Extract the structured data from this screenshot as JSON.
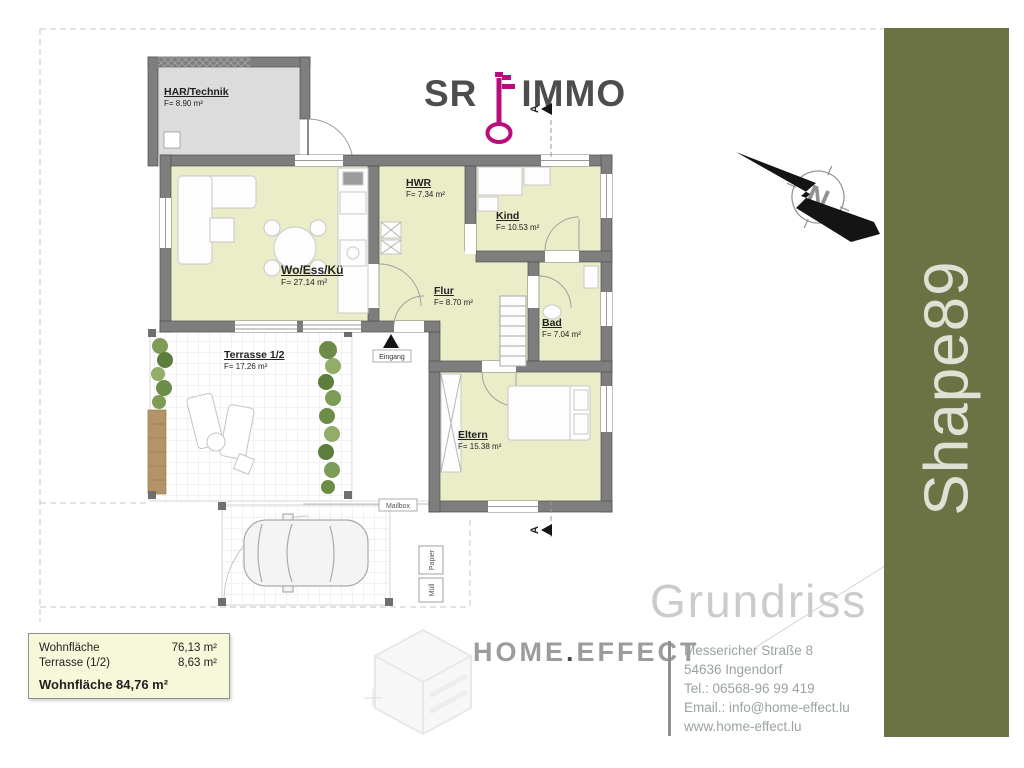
{
  "page": {
    "background": "#ffffff"
  },
  "logo": {
    "sr": "SR",
    "immo": "IMMO",
    "key_color": "#b90d7e",
    "text_color": "#4d4d4d"
  },
  "section_marker": {
    "letter": "A"
  },
  "compass": {
    "north_letter": "N"
  },
  "rooms": [
    {
      "id": "har",
      "name": "HAR/Technik",
      "area": "F= 8.90 m²"
    },
    {
      "id": "wo",
      "name": "Wo/Ess/Kü",
      "area": "F= 27.14 m²"
    },
    {
      "id": "hwr",
      "name": "HWR",
      "area": "F= 7.34 m²"
    },
    {
      "id": "kind",
      "name": "Kind",
      "area": "F= 10.53 m²"
    },
    {
      "id": "flur",
      "name": "Flur",
      "area": "F= 8.70 m²"
    },
    {
      "id": "bad",
      "name": "Bad",
      "area": "F= 7.04 m²"
    },
    {
      "id": "terrasse",
      "name": "Terrasse 1/2",
      "area": "F= 17.26 m²"
    },
    {
      "id": "eltern",
      "name": "Eltern",
      "area": "F= 15.38 m²"
    }
  ],
  "plan_annotations": {
    "eingang": "Eingang",
    "mailbox": "Mailbox",
    "papier": "Papier",
    "muell": "Müll"
  },
  "summary_box": {
    "rows": [
      {
        "label": "Wohnfläche",
        "value": "76,13 m²"
      },
      {
        "label": "Terrasse (1/2)",
        "value": "8,63 m²"
      }
    ],
    "total": "Wohnfläche 84,76 m²"
  },
  "watermark_title": "Grundriss",
  "sidebar": {
    "label": "Shape89",
    "background": "#6b7243",
    "text_color": "#e0e1d4"
  },
  "brand": {
    "primary": "HOME",
    "dot": ".",
    "secondary": "EFFECT"
  },
  "contact": {
    "lines": [
      "Messericher Straße 8",
      "54636 Ingendorf",
      "Tel.: 06568-96 99 419",
      "Email.: info@home-effect.lu",
      "www.home-effect.lu"
    ]
  }
}
